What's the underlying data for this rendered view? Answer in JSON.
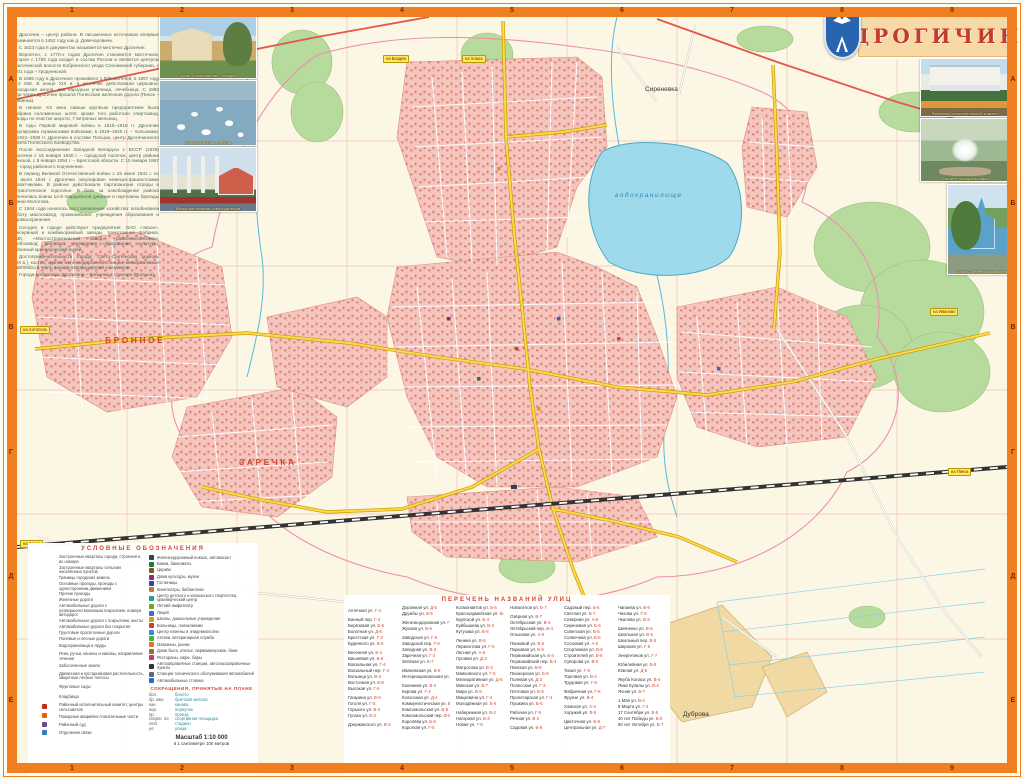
{
  "sheet": {
    "title": "ДРОГИЧИН"
  },
  "history": {
    "paragraphs": [
      "Дрогичин – центр района. В письменных источниках впервые упоминается в 1452 году как д. Довечоровичи.",
      "С 1623 года в документах называется местечко Дрогичин.",
      "Вероятно, с 1770-х годов Дрогичин становится местечком, которое с 1795 года входит в состав России и является центром Дрогичинской волости Кобринского уезда Слонимской губернии, с 1801 года – Гродненской.",
      "В 1886 году в Дрогичине проживало 1 505 жителей, в 1897 году – 2 258. В конце XIX в. в местечке действовали церковно-приходская школа, два народных училища, лечебница. С 1882 года через Дрогичин прошла Полесская железная дорога (Пинск – Жабинка).",
      "В начале XX века самым крупным предприятием была фабрика соломенных шляп; кроме того работали спиртзавод, заводы по очистке шерсти, 7 ветряных мельниц.",
      "В годы Первой мировой войны в 1915–1918 гг. Дрогичин оккупирован германскими войсками, в 1919–1920 гг. – польскими. В 1921–1939 гг. Дрогичин в составе Польши, центр Дрогичинского повета Полесского воеводства.",
      "После воссоединения Западной Беларуси с БССР (1939) Дрогичин с 15 января 1940 г. – городской посёлок, центр района Пинской, с 8 января 1954 г. – Брестской области. С 15 января 1967 г. – город районного подчинения.",
      "В период Великой Отечественной войны с 25 июня 1941 г. по 17 июля 1944 г. Дрогичин оккупирован немецко-фашистскими захватчиками. В районе действовали партизанские отряды и патриотическое подполье. В боях за освобождение района отличились воины 12-й гвардейской дивизии и партизаны бригады имени Молотова.",
      "С 1944 года началось восстановление хозяйства: возобновили работу маслозавод, промкомбинат, учреждения образования и здравоохранения.",
      "Сегодня в городе действуют предприятия: ОАО «Экзон», консервный и комбикормовый заводы, трикотажная фабрика, ПМК, «Мостостроительный завод», райсельхозтехника, хлебозавод; работают учреждения образования, культуры, районный краеведческий музей.",
      "Достопримечательности города: Свято-Сретенская церковь (XIX в.), костёл, здание железнодорожной станции, мемориальные комплексы в честь воинов-освободителей и земляков.",
      "Города-побратимы Дрогичина – Кобылка и Сохачев (Польша)."
    ]
  },
  "photos": {
    "left": [
      {
        "caption": "Храм Преображения Господня"
      },
      {
        "caption": "Водохранилище. Лебеди"
      },
      {
        "caption": "Мемориал воинам-освободителям"
      }
    ],
    "right": [
      {
        "caption": "Районный исполнительный комитет"
      },
      {
        "caption": "Фонтан в городском парке"
      },
      {
        "caption": "Свято-Сретенская церковь"
      }
    ]
  },
  "map": {
    "labels": {
      "sirenevka": "Сиреневка",
      "bronnoe": "БРОННОЕ",
      "zarechka": "ЗАРЕЧКА",
      "dubrova": "Дуброва",
      "reservoir": "водохранилище"
    },
    "road_badges": [
      {
        "label": "на Бездеж",
        "pos": "b1"
      },
      {
        "label": "на Хомск",
        "pos": "b2"
      },
      {
        "label": "на Иваново",
        "pos": "b3"
      },
      {
        "label": "на Антополь",
        "pos": "b4"
      },
      {
        "label": "на Брест",
        "pos": "b5"
      },
      {
        "label": "на Пинск",
        "pos": "b6"
      }
    ],
    "grid": {
      "cols": [
        "1",
        "2",
        "3",
        "4",
        "5",
        "6",
        "7",
        "8",
        "9"
      ],
      "rows": [
        "А",
        "Б",
        "В",
        "Г",
        "Д",
        "Е"
      ]
    }
  },
  "legend": {
    "title": "УСЛОВНЫЕ ОБОЗНАЧЕНИЯ",
    "left": [
      {
        "sw": "sw-city",
        "label": "Застроенные кварталы города, строения и их номера"
      },
      {
        "sw": "sw-village",
        "label": "Застроенные кварталы сельских населённых пунктов"
      },
      {
        "sw": "sw-boundary",
        "label": "Границы городских земель"
      },
      {
        "sw": "sw-drive-main",
        "label": "Основные проезды, проезды с односторонним движением"
      },
      {
        "sw": "sw-drive",
        "label": "Прочие проезды"
      },
      {
        "sw": "sw-rail",
        "label": "Железные дороги"
      },
      {
        "sw": "sw-road-paved-num",
        "label": "Автомобильные дороги с усовершенствованным покрытием, номера автодорог"
      },
      {
        "sw": "sw-road-paved",
        "label": "Автомобильные дороги с покрытием, мосты"
      },
      {
        "sw": "sw-road-unpaved",
        "label": "Автомобильные дороги без покрытия"
      },
      {
        "sw": "sw-road-dirt",
        "label": "Грунтовые просёлочные дороги"
      },
      {
        "sw": "sw-road-field",
        "label": "Полевые и лесные дороги"
      },
      {
        "sw": "sw-water",
        "label": "Водохранилища и пруды"
      },
      {
        "sw": "sw-river",
        "label": "Реки, ручьи, каналы и канавы, направление течения"
      },
      {
        "sw": "sw-swamp",
        "label": "Заболоченные земли"
      },
      {
        "sw": "sw-forest",
        "label": "Древесная и кустарниковая растительность, защитные лесные полосы"
      },
      {
        "sw": "sw-orchard",
        "label": "Фруктовые сады"
      },
      {
        "sw": "sw-cemetery",
        "label": "Кладбища"
      },
      {
        "ic": "ic-admin",
        "label": "Районный исполнительный комитет, центры сельсоветов"
      },
      {
        "ic": "ic-fire",
        "label": "Пожарные аварийно-спасательные части"
      },
      {
        "ic": "ic-court",
        "label": "Районный суд"
      },
      {
        "ic": "ic-post",
        "label": "Отделения связи"
      }
    ],
    "right": [
      {
        "ic": "ic-rail-station",
        "label": "Железнодорожный вокзал, автовокзал"
      },
      {
        "ic": "ic-bank",
        "label": "Банки, банкоматы"
      },
      {
        "ic": "ic-church",
        "label": "Церкви"
      },
      {
        "ic": "ic-culture",
        "label": "Дома культуры, музеи"
      },
      {
        "ic": "ic-hotel",
        "label": "Гостиницы"
      },
      {
        "ic": "ic-cinema",
        "label": "Кинотеатры, библиотеки"
      },
      {
        "ic": "ic-youth",
        "label": "Центр детского и юношеского творчества, краеведческий центр"
      },
      {
        "ic": "ic-camp",
        "label": "Летний амфитеатр"
      },
      {
        "ic": "ic-lyceum",
        "label": "Лицей"
      },
      {
        "ic": "ic-school",
        "label": "Школы, дошкольные учреждения"
      },
      {
        "ic": "ic-hospital",
        "label": "Больницы, поликлиники"
      },
      {
        "ic": "ic-hygiene",
        "label": "Центр гигиены и эпидемиологии"
      },
      {
        "ic": "ic-pharmacy",
        "label": "Аптеки, ветеринарная служба"
      },
      {
        "ic": "ic-shop",
        "label": "Магазины, рынки"
      },
      {
        "ic": "ic-service",
        "label": "Дома быта, ателье, парикмахерские, бани"
      },
      {
        "ic": "ic-cafe",
        "label": "Рестораны, кафе, бары"
      },
      {
        "ic": "ic-gas",
        "label": "Автозаправочные станции, автогазозаправочные пункты"
      },
      {
        "ic": "ic-sto",
        "label": "Станции технического обслуживания автомобилей"
      },
      {
        "ic": "ic-parking",
        "label": "Автомобильные стоянки"
      }
    ],
    "abbr_title": "СОКРАЩЕНИЯ, ПРИНЯТЫЕ НА ПЛАНЕ",
    "abbreviations": [
      {
        "a": "бол.",
        "m": "болото"
      },
      {
        "a": "бр. мог.",
        "m": "братская могила"
      },
      {
        "a": "кан.",
        "m": "канава"
      },
      {
        "a": "пер.",
        "m": "переулок"
      },
      {
        "a": "пр.",
        "m": "проезд"
      },
      {
        "a": "спорт. пл.",
        "m": "спортивная площадка"
      },
      {
        "a": "стд.",
        "m": "стадион"
      },
      {
        "a": "ул.",
        "m": "улица"
      }
    ],
    "scale": "Масштаб 1:10 000",
    "scale_note": "в 1 сантиметре 100 метров"
  },
  "index": {
    "title": "ПЕРЕЧЕНЬ НАЗВАНИЙ УЛИЦ",
    "entries": [
      {
        "n": "Аптечная ул.",
        "r": "Г-4",
        "g": "g"
      },
      {
        "n": "Банный пер.",
        "r": "Г-4",
        "g": "g"
      },
      {
        "n": "Берёзовая ул.",
        "r": "Б-5"
      },
      {
        "n": "Болотная ул.",
        "r": "Д-6"
      },
      {
        "n": "Брестская ул.",
        "r": "Г-3"
      },
      {
        "n": "Будённого ул.",
        "r": "В-6"
      },
      {
        "n": "Весенняя ул.",
        "r": "Б-4",
        "g": "g"
      },
      {
        "n": "Вишнёвая ул.",
        "r": "Б-6"
      },
      {
        "n": "Вокзальная ул.",
        "r": "Г-4"
      },
      {
        "n": "Вокзальный пер.",
        "r": "Г-4"
      },
      {
        "n": "Волынца ул.",
        "r": "В-3"
      },
      {
        "n": "Восточная ул.",
        "r": "В-8"
      },
      {
        "n": "Высокая ул.",
        "r": "Г-5"
      },
      {
        "n": "Гагарина ул.",
        "r": "В-5",
        "g": "g"
      },
      {
        "n": "Гоголя ул.",
        "r": "Г-5"
      },
      {
        "n": "Горького ул.",
        "r": "В-4"
      },
      {
        "n": "Гусака ул.",
        "r": "Б-3"
      },
      {
        "n": "Дзержинского ул.",
        "r": "В-4",
        "g": "g"
      },
      {
        "n": "Дорожная ул.",
        "r": "Д-5"
      },
      {
        "n": "Дружбы ул.",
        "r": "Б-5"
      },
      {
        "n": "Железнодорожная ул.",
        "r": "Г-3",
        "g": "g"
      },
      {
        "n": "Жукова ул.",
        "r": "В-6"
      },
      {
        "n": "Заводская ул.",
        "r": "Г-6",
        "g": "g"
      },
      {
        "n": "Заводской пер.",
        "r": "Г-6"
      },
      {
        "n": "Западная ул.",
        "r": "В-2"
      },
      {
        "n": "Заречная ул.",
        "r": "Г-2"
      },
      {
        "n": "Зелёная ул.",
        "r": "Б-7"
      },
      {
        "n": "Ивановская ул.",
        "r": "В-8",
        "g": "g"
      },
      {
        "n": "Интернациональная ул.",
        "r": "В-5"
      },
      {
        "n": "Калинина ул.",
        "r": "В-4",
        "g": "g"
      },
      {
        "n": "Кирова ул.",
        "r": "Г-4"
      },
      {
        "n": "Колхозная ул.",
        "r": "Д-4"
      },
      {
        "n": "Коммунистическая ул.",
        "r": "В-4"
      },
      {
        "n": "Комсомольская ул.",
        "r": "В-5"
      },
      {
        "n": "Комсомольский пер.",
        "r": "В-5"
      },
      {
        "n": "Королёва ул.",
        "r": "Б-6"
      },
      {
        "n": "Короткая ул.",
        "r": "Г-5"
      },
      {
        "n": "Космонавтов ул.",
        "r": "Б-5"
      },
      {
        "n": "Красноармейская ул.",
        "r": "В-4"
      },
      {
        "n": "Крупской ул.",
        "r": "Б-4"
      },
      {
        "n": "Куйбышева ул.",
        "r": "В-3"
      },
      {
        "n": "Кутузова ул.",
        "r": "В-6"
      },
      {
        "n": "Ленина ул.",
        "r": "В-5",
        "g": "g"
      },
      {
        "n": "Лермонтова ул.",
        "r": "Г-5"
      },
      {
        "n": "Лесная ул.",
        "r": "А-6"
      },
      {
        "n": "Луговая ул.",
        "r": "Д-3"
      },
      {
        "n": "Матросова ул.",
        "r": "В-3",
        "g": "g"
      },
      {
        "n": "Маяковского ул.",
        "r": "Г-5"
      },
      {
        "n": "Мелиоративная ул.",
        "r": "Д-6"
      },
      {
        "n": "Минская ул.",
        "r": "В-7"
      },
      {
        "n": "Мира ул.",
        "r": "В-5"
      },
      {
        "n": "Мицкевича ул.",
        "r": "Г-4"
      },
      {
        "n": "Молодёжная ул.",
        "r": "Б-5"
      },
      {
        "n": "Набережная ул.",
        "r": "В-2",
        "g": "g"
      },
      {
        "n": "Нагорная ул.",
        "r": "Б-3"
      },
      {
        "n": "Новая ул.",
        "r": "Г-6"
      },
      {
        "n": "Новосёлов ул.",
        "r": "Б-7"
      },
      {
        "n": "Озёрная ул.",
        "r": "В-7",
        "g": "g"
      },
      {
        "n": "Октябрьская ул.",
        "r": "В-4"
      },
      {
        "n": "Октябрьский пер.",
        "r": "В-4"
      },
      {
        "n": "Ольховая ул.",
        "r": "А-5"
      },
      {
        "n": "Панковой ул.",
        "r": "В-5",
        "g": "g"
      },
      {
        "n": "Парковая ул.",
        "r": "Б-5"
      },
      {
        "n": "Первомайская ул.",
        "r": "В-4"
      },
      {
        "n": "Первомайский пер.",
        "r": "В-4"
      },
      {
        "n": "Пинская ул.",
        "r": "В-8"
      },
      {
        "n": "Пионерская ул.",
        "r": "Б-5"
      },
      {
        "n": "Полевая ул.",
        "r": "Д-2"
      },
      {
        "n": "Полесская ул.",
        "r": "Г-3"
      },
      {
        "n": "Почтовая ул.",
        "r": "В-5"
      },
      {
        "n": "Пролетарская ул.",
        "r": "Г-4"
      },
      {
        "n": "Пушкина ул.",
        "r": "В-5"
      },
      {
        "n": "Рабочая ул.",
        "r": "Г-5",
        "g": "g"
      },
      {
        "n": "Речная ул.",
        "r": "В-2"
      },
      {
        "n": "Садовая ул.",
        "r": "Б-6",
        "g": "g"
      },
      {
        "n": "Садовый пер.",
        "r": "Б-6"
      },
      {
        "n": "Светлая ул.",
        "r": "Б-7"
      },
      {
        "n": "Северная ул.",
        "r": "А-5"
      },
      {
        "n": "Сиреневая ул.",
        "r": "Б-6"
      },
      {
        "n": "Советская ул.",
        "r": "В-5"
      },
      {
        "n": "Солнечная ул.",
        "r": "Б-6"
      },
      {
        "n": "Сосновая ул.",
        "r": "А-6"
      },
      {
        "n": "Спортивная ул.",
        "r": "В-6"
      },
      {
        "n": "Строителей ул.",
        "r": "Б-6"
      },
      {
        "n": "Суворова ул.",
        "r": "В-6"
      },
      {
        "n": "Тихая ул.",
        "r": "Г-6",
        "g": "g"
      },
      {
        "n": "Торговая ул.",
        "r": "В-4"
      },
      {
        "n": "Трудовая ул.",
        "r": "Г-5"
      },
      {
        "n": "Фабричная ул.",
        "r": "Г-6",
        "g": "g"
      },
      {
        "n": "Фрунзе ул.",
        "r": "В-4"
      },
      {
        "n": "Хомская ул.",
        "r": "А-4",
        "g": "g"
      },
      {
        "n": "Хоружей ул.",
        "r": "В-5"
      },
      {
        "n": "Цветочная ул.",
        "r": "Б-6",
        "g": "g"
      },
      {
        "n": "Центральная ул.",
        "r": "Д-7"
      },
      {
        "n": "Чапаева ул.",
        "r": "В-6",
        "g": "g"
      },
      {
        "n": "Чехова ул.",
        "r": "Г-5"
      },
      {
        "n": "Чкалова ул.",
        "r": "В-3"
      },
      {
        "n": "Шевченко ул.",
        "r": "В-5",
        "g": "g"
      },
      {
        "n": "Школьная ул.",
        "r": "В-5"
      },
      {
        "n": "Школьный пер.",
        "r": "В-5"
      },
      {
        "n": "Широкая ул.",
        "r": "Г-6"
      },
      {
        "n": "Энергетиков ул.",
        "r": "Г-7",
        "g": "g"
      },
      {
        "n": "Юбилейная ул.",
        "r": "Б-5",
        "g": "g"
      },
      {
        "n": "Южная ул.",
        "r": "Д-5"
      },
      {
        "n": "Якуба Коласа ул.",
        "r": "В-4",
        "g": "g"
      },
      {
        "n": "Янки Купалы ул.",
        "r": "В-4"
      },
      {
        "n": "Ясная ул.",
        "r": "Б-7"
      },
      {
        "n": "1 Мая ул.",
        "r": "В-4",
        "g": "g"
      },
      {
        "n": "8 Марта ул.",
        "r": "Г-4"
      },
      {
        "n": "17 Сентября ул.",
        "r": "В-5"
      },
      {
        "n": "40 лет Победы ул.",
        "r": "Б-6"
      },
      {
        "n": "60 лет Октября ул.",
        "r": "Б-7"
      }
    ]
  }
}
